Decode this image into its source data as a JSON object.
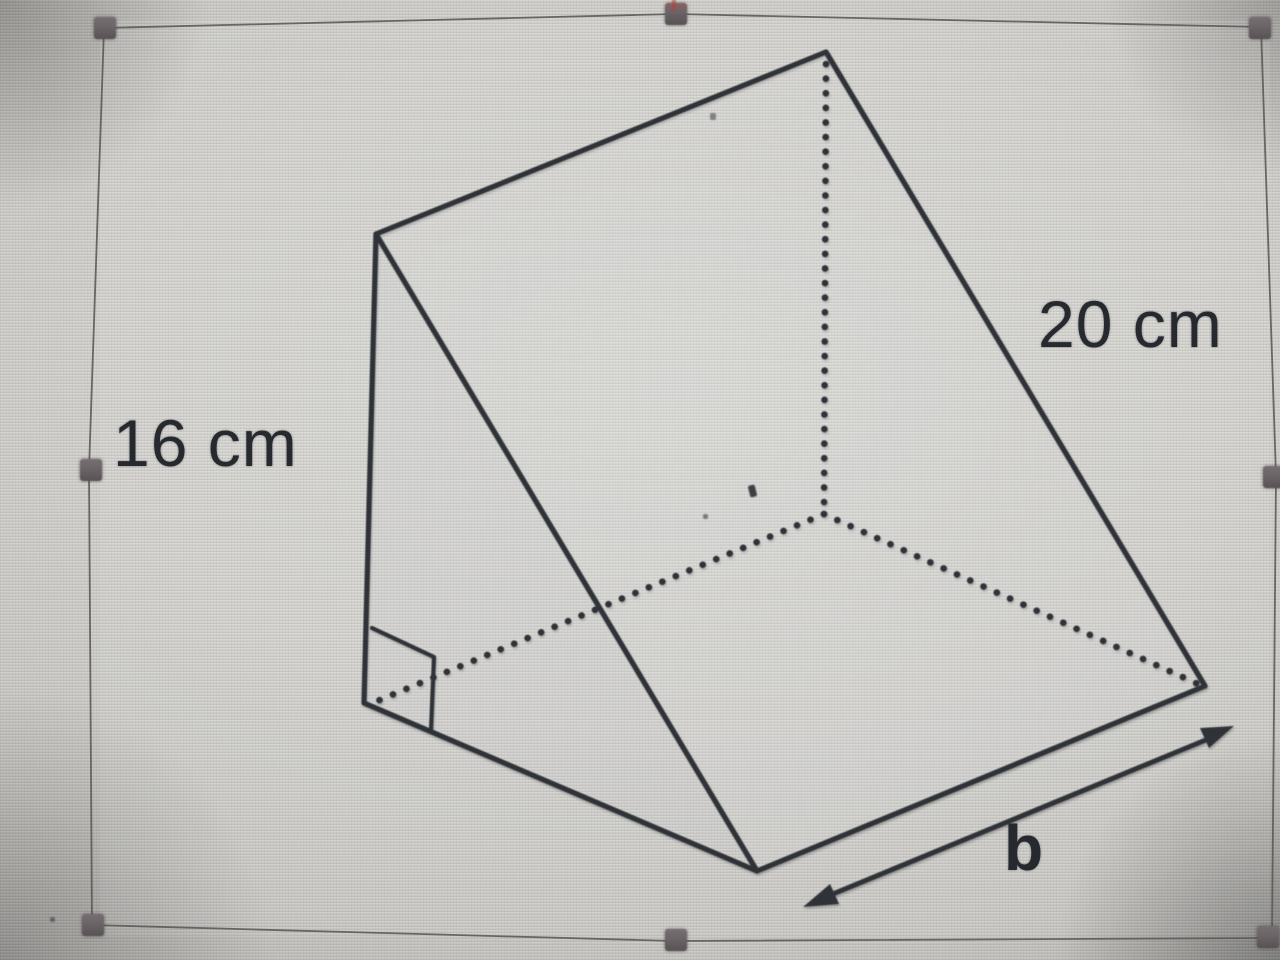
{
  "figure": {
    "shape": "triangular-prism",
    "labels": {
      "height": "16 cm",
      "slant": "20 cm",
      "depth": "b"
    }
  },
  "colors": {
    "line": "#2f3338",
    "label_text": "#26292e",
    "selection_border": "#5f5a58",
    "handle": "#6b6466",
    "screen_center": "#d6d5d2",
    "screen_edge": "#9b9a97"
  },
  "selection": {
    "handles": [
      "top-left",
      "top-middle",
      "top-right",
      "middle-left",
      "middle-right",
      "bottom-left",
      "bottom-middle",
      "bottom-right"
    ]
  }
}
